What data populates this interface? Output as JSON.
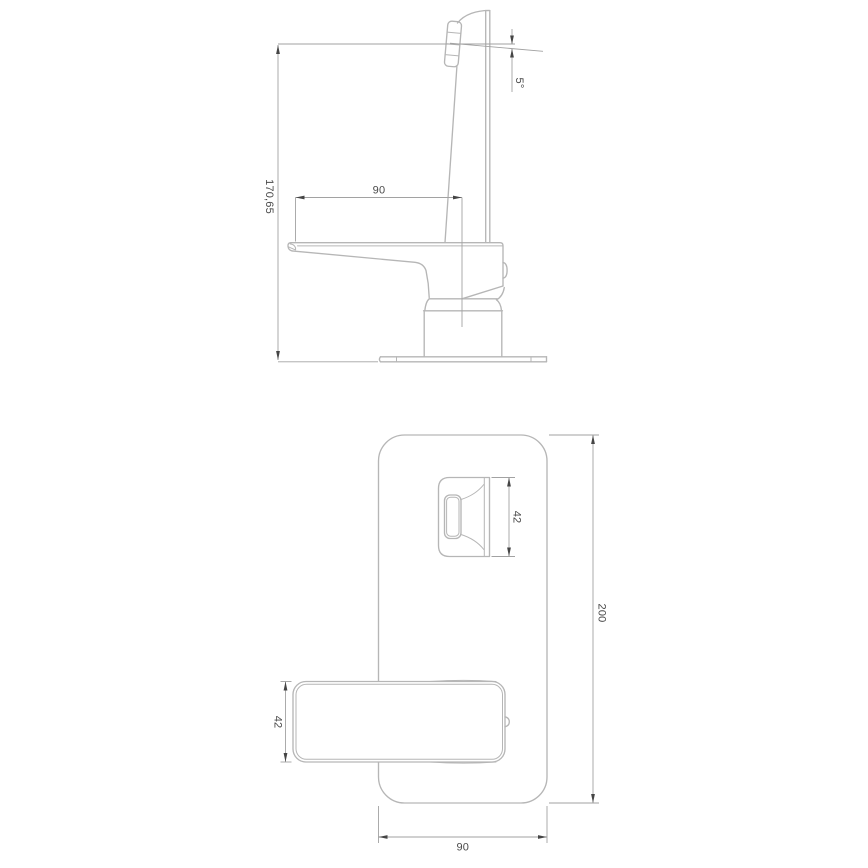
{
  "dimensions": {
    "side_view": {
      "height": "170,65",
      "reach": "90",
      "spout_angle": "5°"
    },
    "plan_view": {
      "spout_width": "42",
      "plate_length": "200",
      "handle_width": "42",
      "plate_width": "90"
    }
  },
  "colors": {
    "background": "#ffffff",
    "outline": "#b6b6b6",
    "dimension_line": "#a2a2a2",
    "arrow": "#454545",
    "label_text": "#4a4a4a"
  }
}
